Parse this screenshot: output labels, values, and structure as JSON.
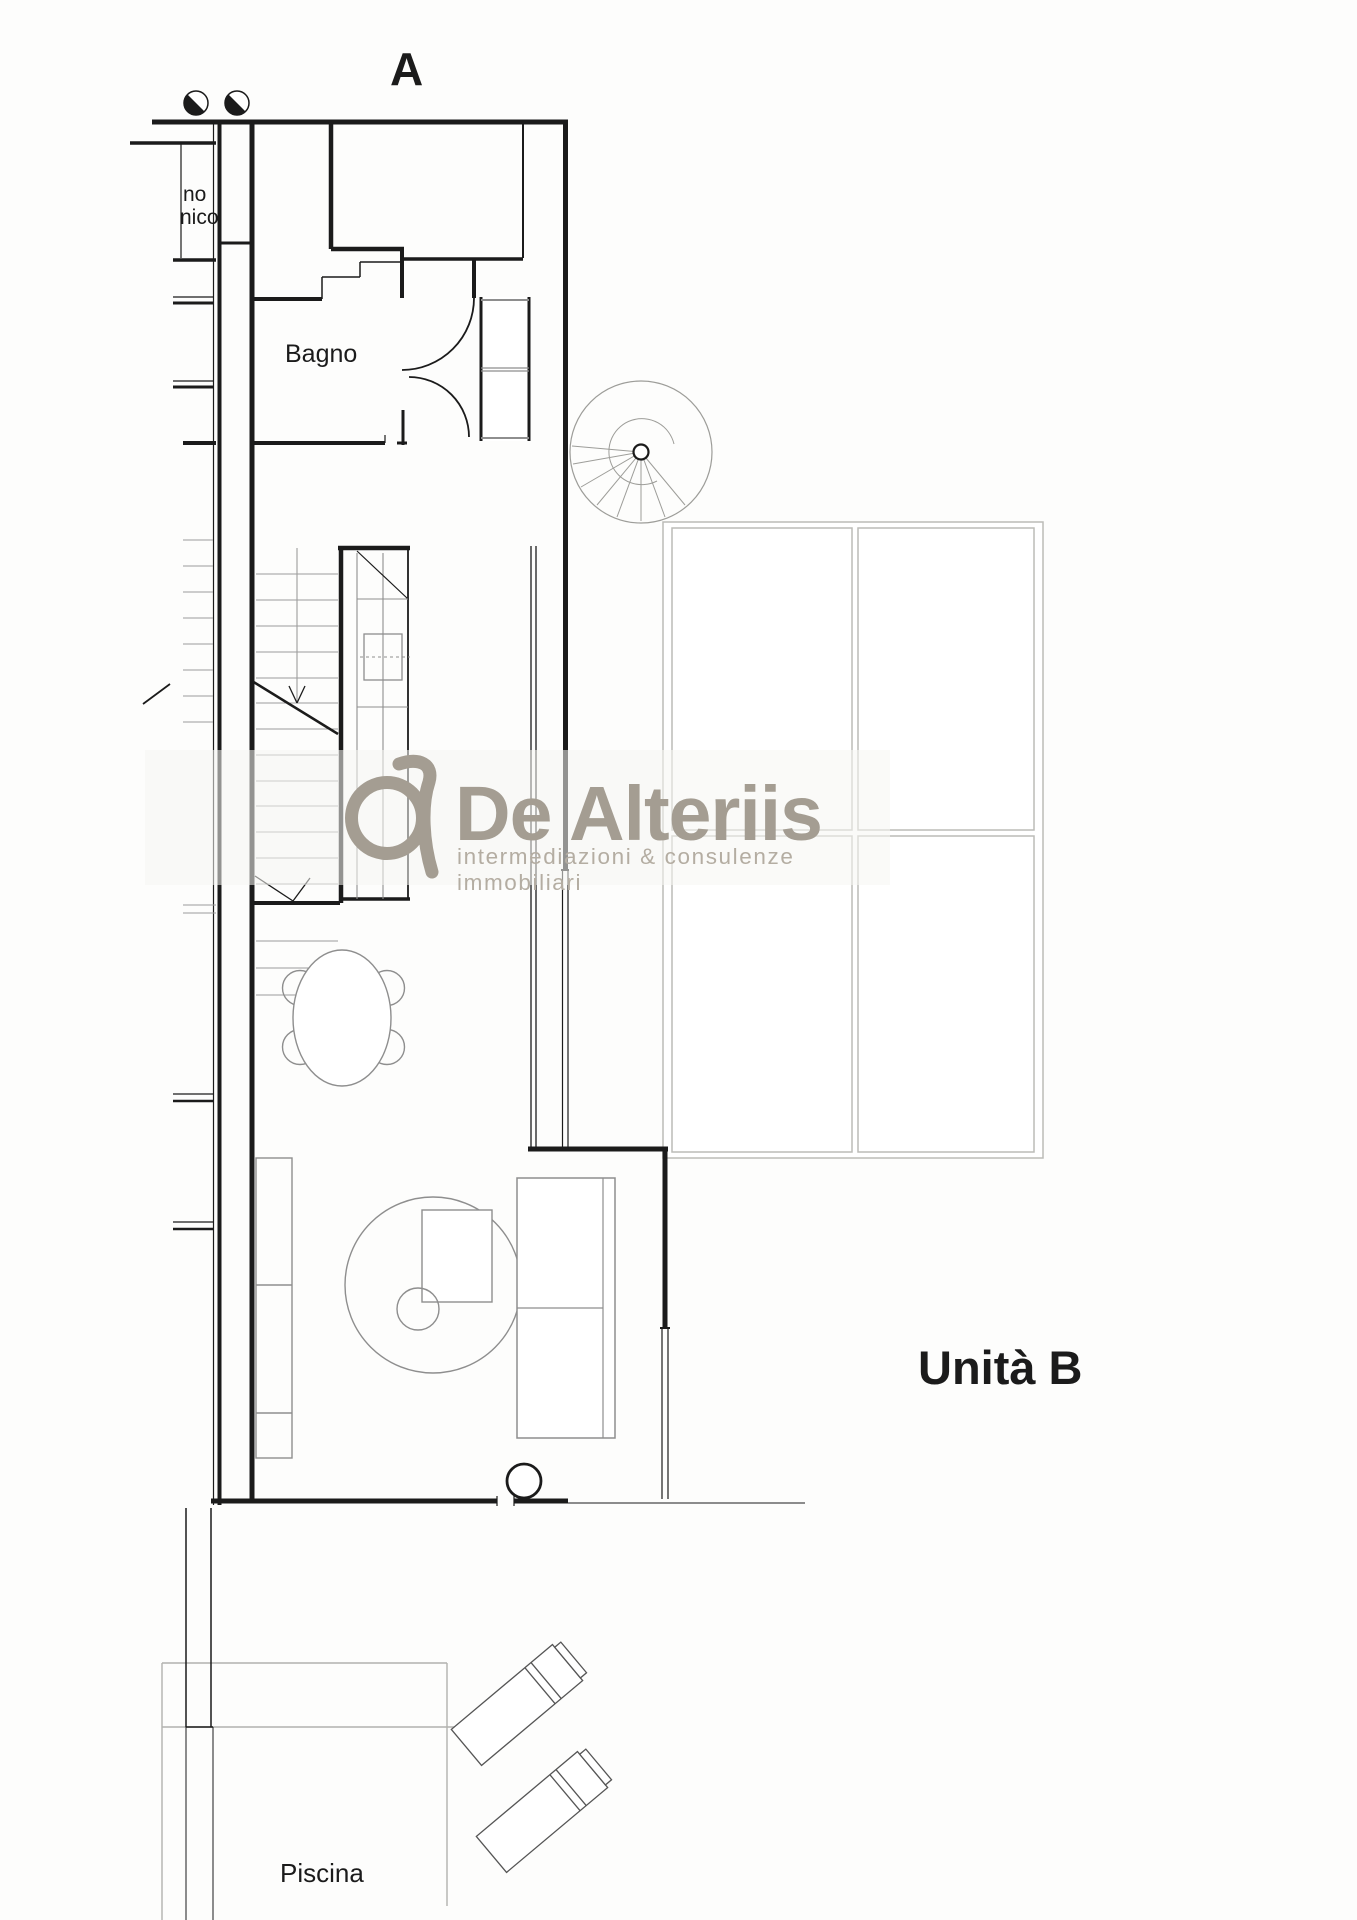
{
  "page": {
    "type": "architectural-floor-plan",
    "background": "#fdfdfc"
  },
  "labels": {
    "section": "A",
    "clipped_room_line1": "no",
    "clipped_room_line2": "nico",
    "bathroom": "Bagno",
    "unit": "Unità B",
    "pool": "Piscina"
  },
  "watermark": {
    "brand": "De Alteriis",
    "tagline": "intermediazioni & consulenze immobiliari",
    "brand_color": "#a49d92",
    "tagline_color": "#b4ada2",
    "logo_icon": "de-alteriis-monogram"
  },
  "plan": {
    "wall_color": "#1b1b1b",
    "furniture_color": "#8e8e8e",
    "tread_color": "#9c9c9c",
    "pergola_color": "#bcbcb7",
    "pool_line_color": "#b2b2ae",
    "icons": [
      "section-marker-icon",
      "door-swing-icon",
      "staircase-icon",
      "spiral-staircase-icon",
      "kitchen-counter-icon",
      "wardrobe-icon",
      "dining-table-icon",
      "sideboard-icon",
      "round-armchair-icon",
      "sofa-icon",
      "column-icon",
      "pergola-grid-icon",
      "lounge-chair-icon"
    ]
  }
}
